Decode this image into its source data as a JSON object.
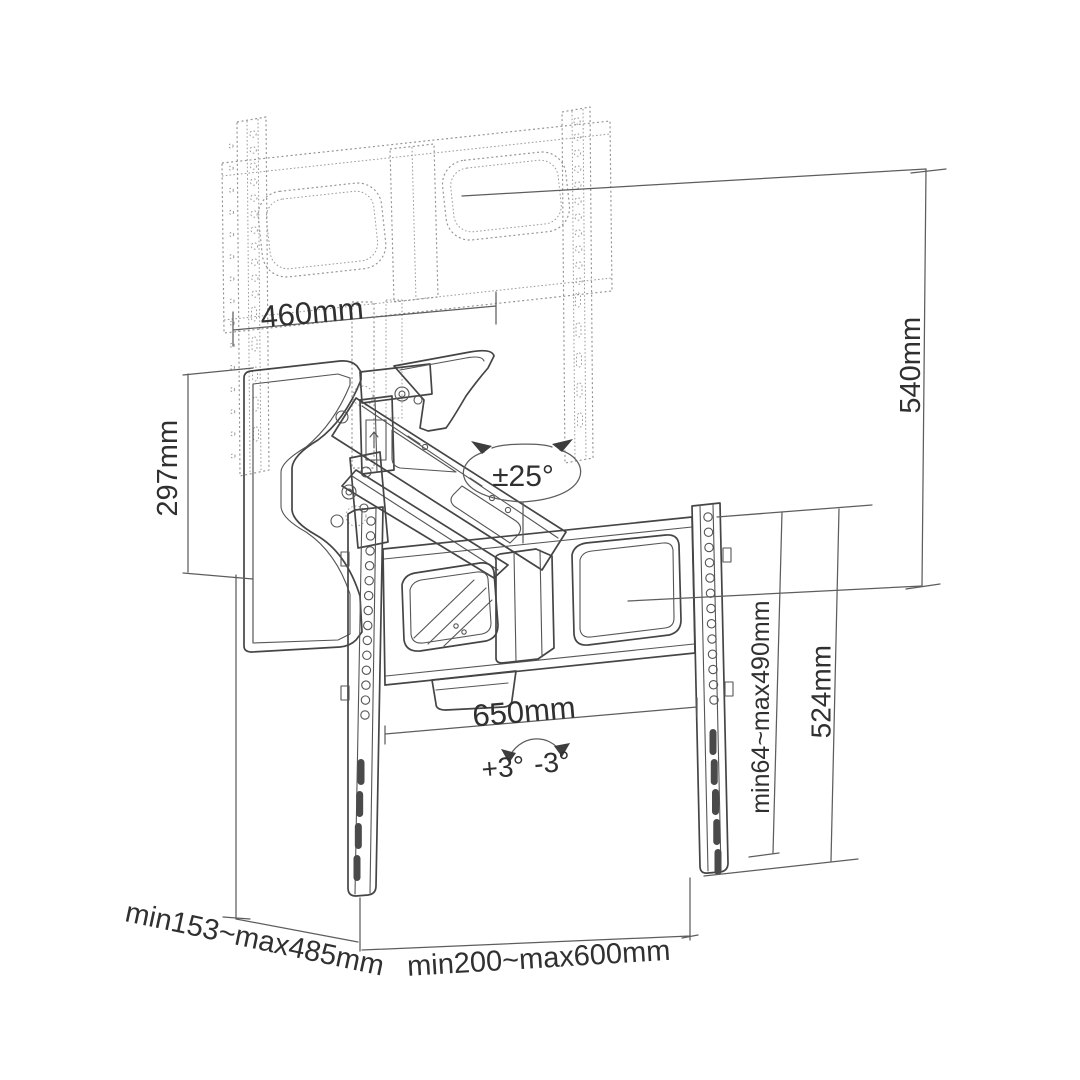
{
  "diagram": {
    "title": "tv-wall-mount-dimension-diagram",
    "labels": {
      "top_width": "460mm",
      "right_height": "540mm",
      "left_height": "297mm",
      "swivel_angle": "±25°",
      "bracket_width": "650mm",
      "tilt_up": "+3°",
      "tilt_down": "-3°",
      "vesa_height_range": "min64~max490mm",
      "bracket_height": "524mm",
      "extension_range": "min153~max485mm",
      "vesa_width_range": "min200~max600mm"
    },
    "colors": {
      "background": "#ffffff",
      "solid_line": "#454545",
      "ghost_line": "#929292",
      "text": "#303030"
    }
  }
}
